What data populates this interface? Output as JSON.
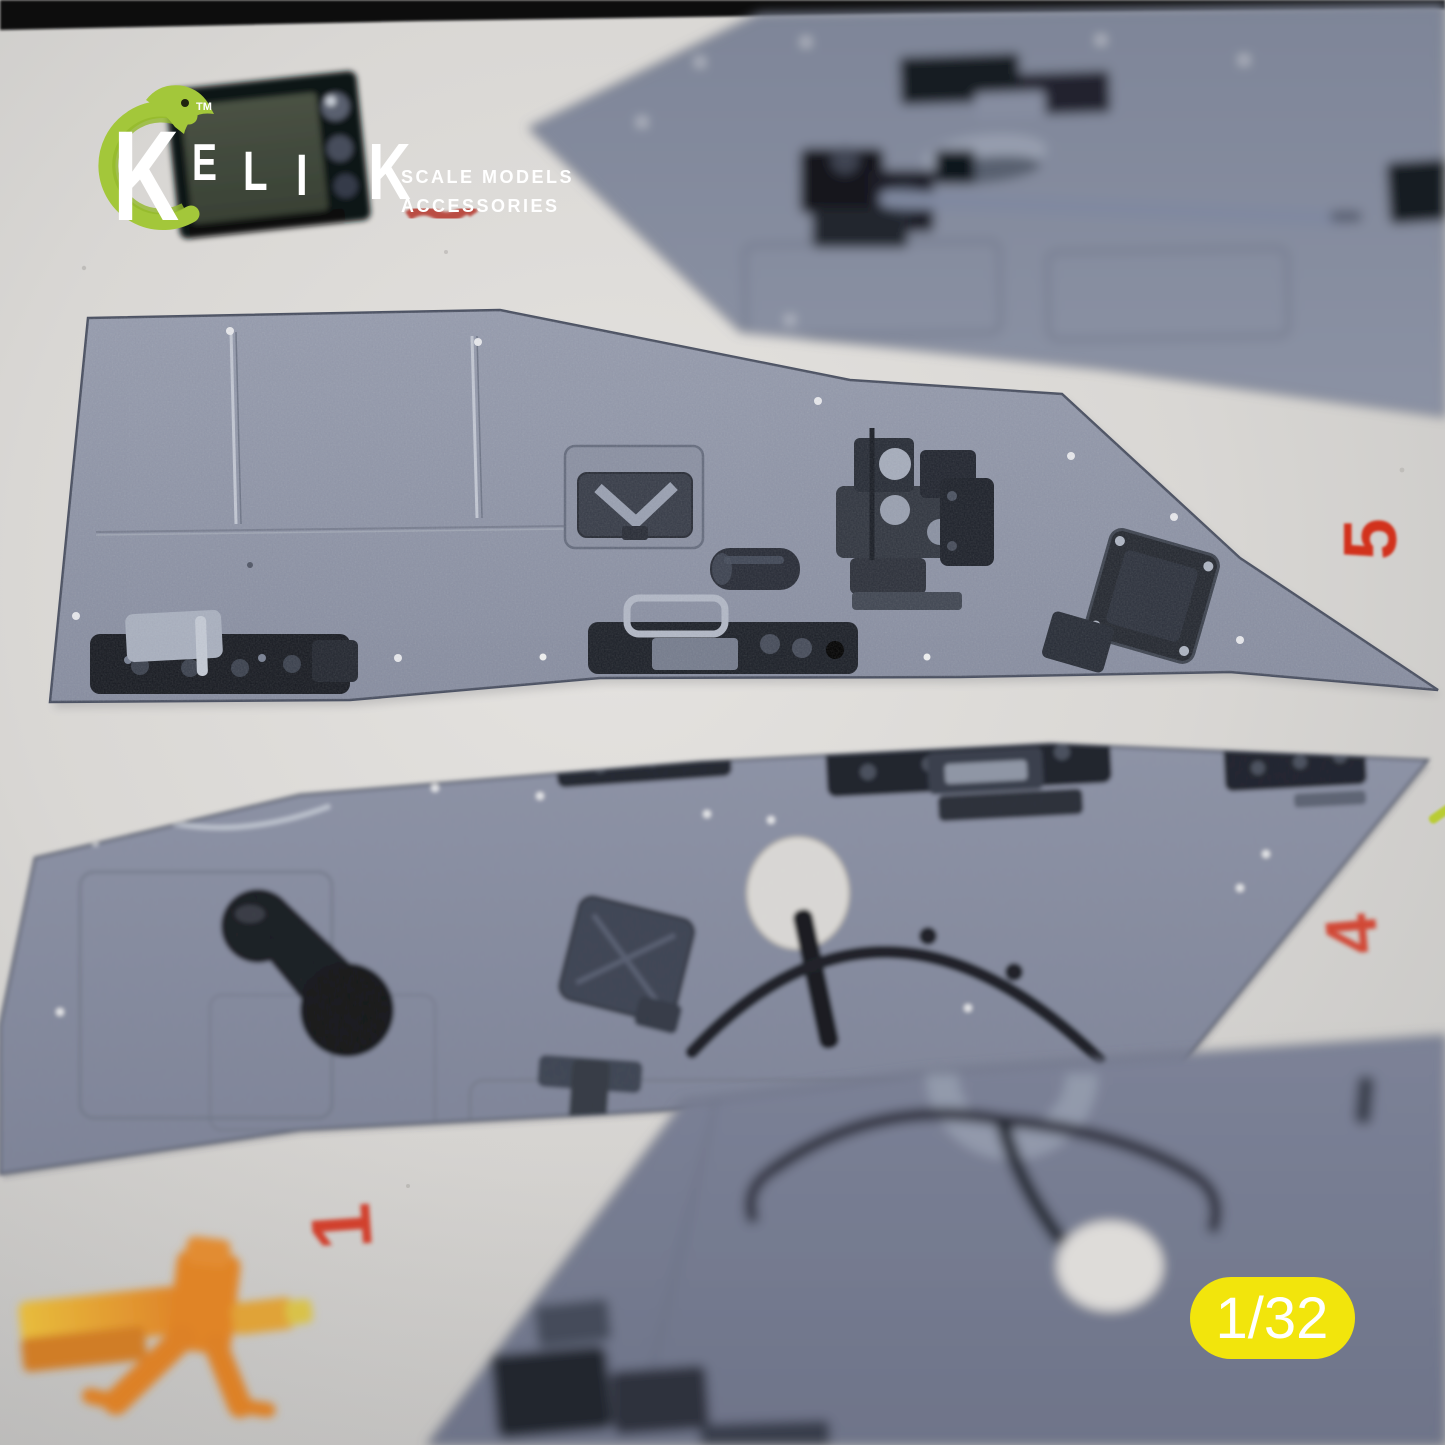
{
  "brand": {
    "initial": "K",
    "letters": [
      "E",
      "L",
      "I",
      "K"
    ],
    "trademark": "TM",
    "tagline_line1": "SCALE MODELS",
    "tagline_line2": "ACCESSORIES"
  },
  "badge": {
    "scale": "1/32"
  },
  "sheet_markers": {
    "marker_5": "5",
    "marker_4": "4",
    "marker_1": "1"
  },
  "colors": {
    "brand_green": "#a3c73a",
    "logo_text": "#ffffff",
    "badge_yellow": "#f2e50c",
    "badge_text": "#ffffff",
    "marker_red": "#d2301f",
    "panel_blue_grey": "#8d93a6",
    "paper": "#d9d7d4"
  }
}
